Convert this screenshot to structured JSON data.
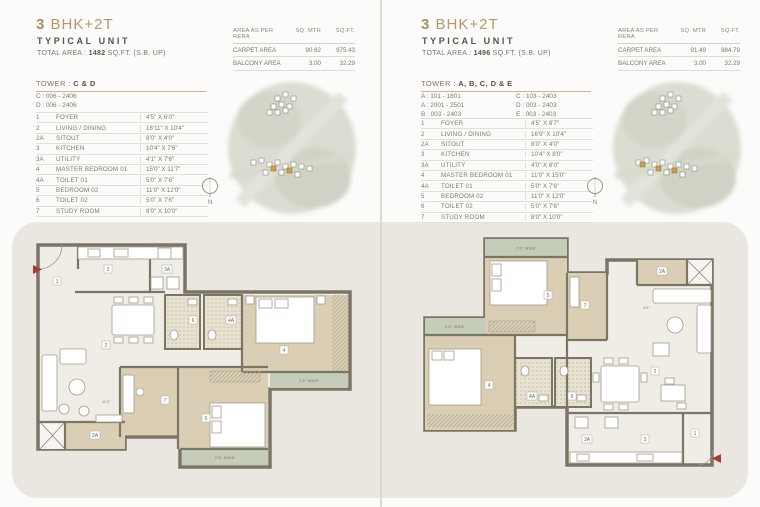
{
  "colors": {
    "accent_gold": "#b2986a",
    "wall": "#7b7566",
    "room_beige": "#dacfb4",
    "balcony_green": "#c5ccba",
    "board_gray": "#e9e7e0",
    "entry_arrow_red": "#a63c30"
  },
  "panels": [
    {
      "title_num": "3",
      "title_rest": "BHK+2T",
      "subtitle": "TYPICAL UNIT",
      "total_area_prefix": "TOTAL AREA :",
      "total_area_value": "1482",
      "total_area_suffix": "SQ.FT. (S.B. UP)",
      "rera": {
        "col_headers": [
          "AREA AS PER RERA",
          "SQ. MTR",
          "SQ.FT."
        ],
        "rows": [
          {
            "label": "CARPET AREA",
            "sq_mtr": "90.62",
            "sq_ft": "975.43"
          },
          {
            "label": "BALCONY AREA",
            "sq_mtr": "3.00",
            "sq_ft": "32.29"
          }
        ]
      },
      "tower_prefix": "TOWER :",
      "tower_value": "C & D",
      "tower_col1": [
        "C : 006 - 2406",
        "D : 006 - 2406",
        ""
      ],
      "tower_col2": [
        "",
        "",
        ""
      ],
      "rooms": [
        {
          "num": "1",
          "name": "FOYER",
          "dim": "4'5\" X 6'0\""
        },
        {
          "num": "2",
          "name": "LIVING / DINING",
          "dim": "16'11\" X 10'4\""
        },
        {
          "num": "2A",
          "name": "SITOUT",
          "dim": "8'0\" X 4'0\""
        },
        {
          "num": "3",
          "name": "KITCHEN",
          "dim": "10'4\" X 7'6\""
        },
        {
          "num": "3A",
          "name": "UTILITY",
          "dim": "4'1\" X 7'6\""
        },
        {
          "num": "4",
          "name": "MASTER BEDROOM 01",
          "dim": "15'0\" X 11'7\""
        },
        {
          "num": "4A",
          "name": "TOILET 01",
          "dim": "5'0\" X 7'6\""
        },
        {
          "num": "5",
          "name": "BEDROOM 02",
          "dim": "11'0\" X 12'0\""
        },
        {
          "num": "6",
          "name": "TOILET 02",
          "dim": "5'0\" X 7'6\""
        },
        {
          "num": "7",
          "name": "STUDY ROOM",
          "dim": "8'0\" X 10'0\""
        }
      ],
      "compass": "N",
      "plan": {
        "balcony_label_1": "2'6\" WIDE",
        "balcony_label_2": "2'6\" WIDE",
        "inline_dim": "11'0\""
      }
    },
    {
      "title_num": "3",
      "title_rest": "BHK+2T",
      "subtitle": "TYPICAL UNIT",
      "total_area_prefix": "TOTAL AREA :",
      "total_area_value": "1496",
      "total_area_suffix": "SQ.FT. (S.B. UP)",
      "rera": {
        "col_headers": [
          "AREA AS PER RERA",
          "SQ. MTR",
          "SQ.FT."
        ],
        "rows": [
          {
            "label": "CARPET AREA",
            "sq_mtr": "91.49",
            "sq_ft": "984.79"
          },
          {
            "label": "BALCONY AREA",
            "sq_mtr": "3.00",
            "sq_ft": "32.29"
          }
        ]
      },
      "tower_prefix": "TOWER :",
      "tower_value": "A, B, C, D & E",
      "tower_col1": [
        "A : 101 - 1801",
        "A : 2001 - 2501",
        "B : 003 - 2403"
      ],
      "tower_col2": [
        "C : 103 - 2403",
        "D : 003 - 2403",
        "E : 003 - 2403"
      ],
      "rooms": [
        {
          "num": "1",
          "name": "FOYER",
          "dim": "4'5\" X 8'7\""
        },
        {
          "num": "2",
          "name": "LIVING / DINING",
          "dim": "16'9\" X 10'4\""
        },
        {
          "num": "2A",
          "name": "SITOUT",
          "dim": "8'0\" X 4'0\""
        },
        {
          "num": "3",
          "name": "KITCHEN",
          "dim": "10'4\" X 8'0\""
        },
        {
          "num": "3A",
          "name": "UTILITY",
          "dim": "4'0\" X 8'0\""
        },
        {
          "num": "4",
          "name": "MASTER BEDROOM 01",
          "dim": "11'0\" X 15'0\""
        },
        {
          "num": "4A",
          "name": "TOILET 01",
          "dim": "5'0\" X 7'6\""
        },
        {
          "num": "5",
          "name": "BEDROOM 02",
          "dim": "11'0\" X 12'0\""
        },
        {
          "num": "6",
          "name": "TOILET 02",
          "dim": "5'0\" X 7'6\""
        },
        {
          "num": "7",
          "name": "STUDY ROOM",
          "dim": "8'0\" X 10'0\""
        }
      ],
      "compass": "N",
      "plan": {
        "balcony_label_1": "2'6\" WIDE",
        "balcony_label_2": "2'6\" WIDE",
        "inline_dim": "9'0\""
      }
    }
  ]
}
